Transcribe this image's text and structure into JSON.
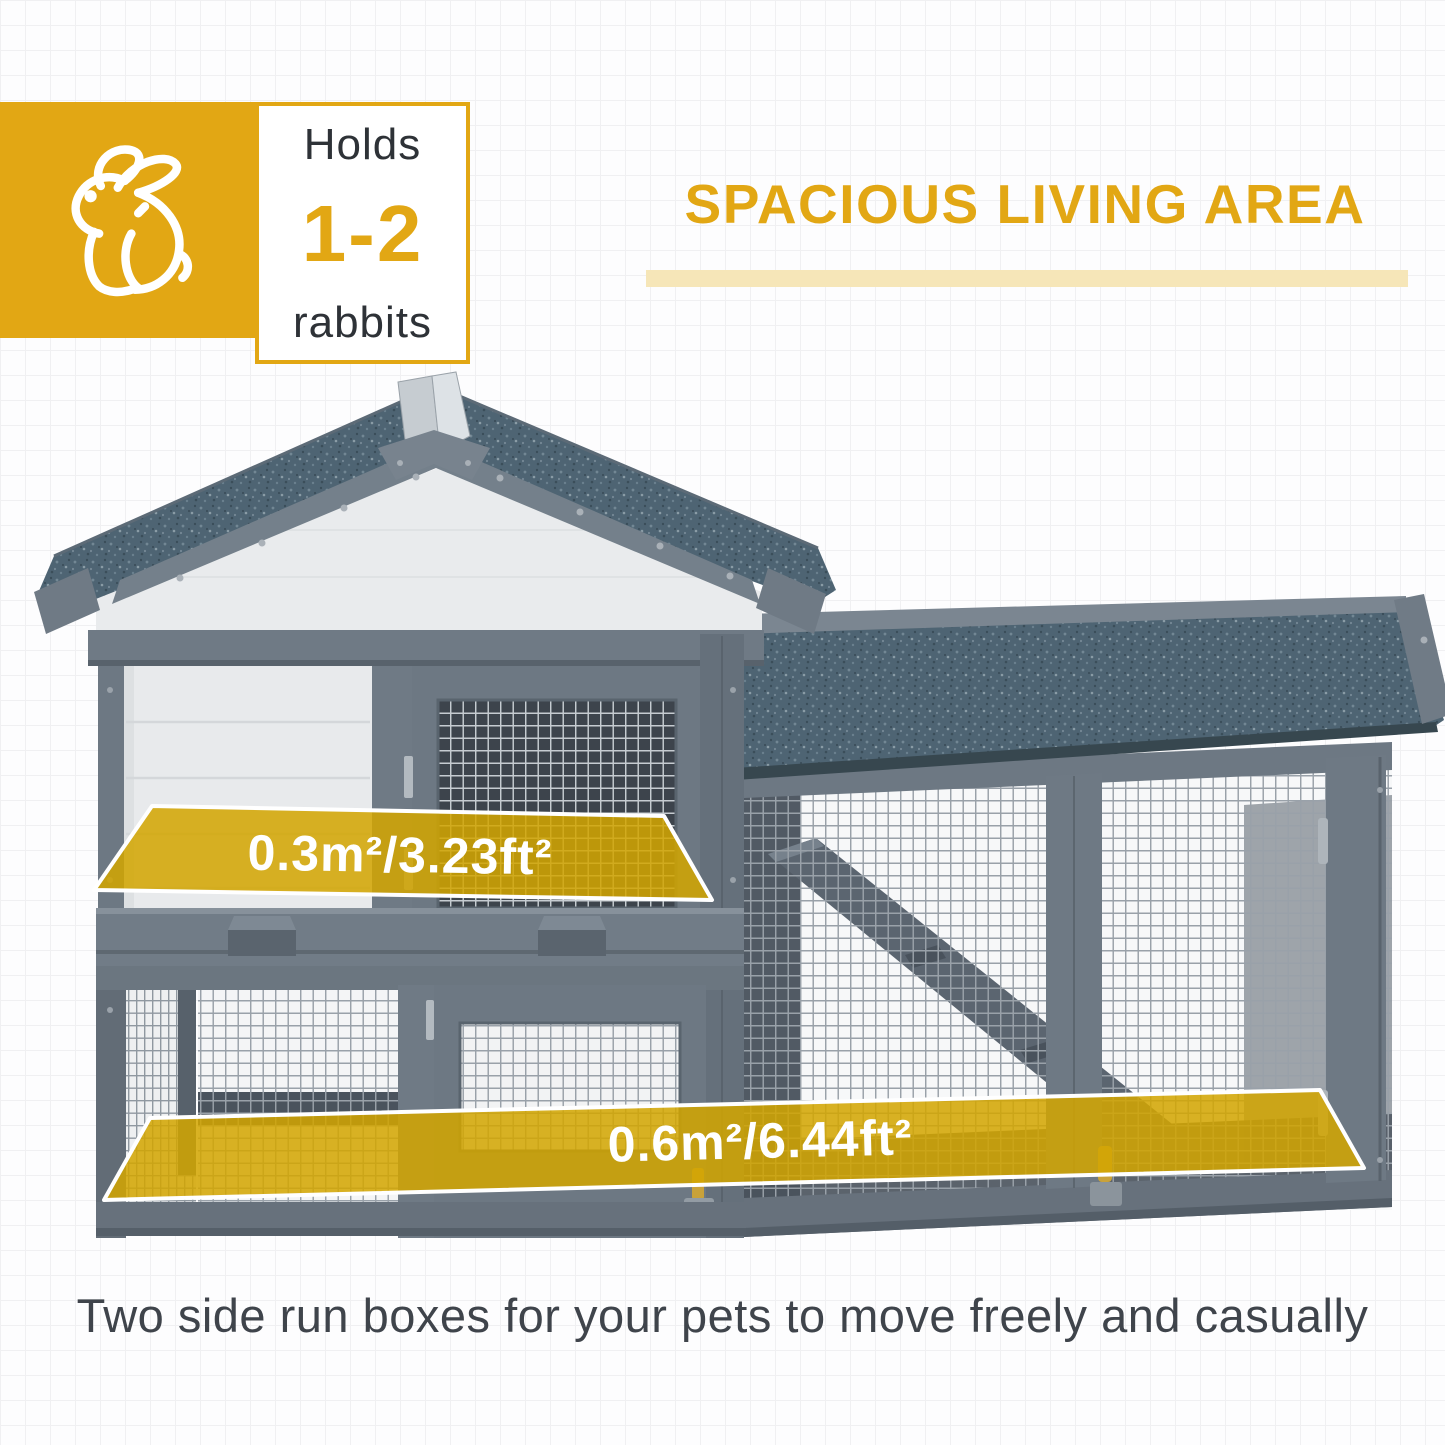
{
  "badge": {
    "icon": "rabbit-icon",
    "holds_label": "Holds",
    "count": "1-2",
    "animal_label": "rabbits"
  },
  "heading": {
    "title": "SPACIOUS LIVING AREA"
  },
  "hutch": {
    "area_labels": [
      {
        "text": "0.3m²/3.23ft²"
      },
      {
        "text": "0.6m²/6.44ft²"
      }
    ]
  },
  "caption": {
    "text": "Two side run boxes for your pets to move freely and casually"
  },
  "colors": {
    "accent_yellow": "#e2a714",
    "overlay_yellow": "#d3a500",
    "underline_yellow": "#f6e6b8",
    "roof_blue": "#4e6473",
    "wood_gray": "#6e7984",
    "text_dark": "#2e3237",
    "caption_gray": "#3f444b"
  }
}
